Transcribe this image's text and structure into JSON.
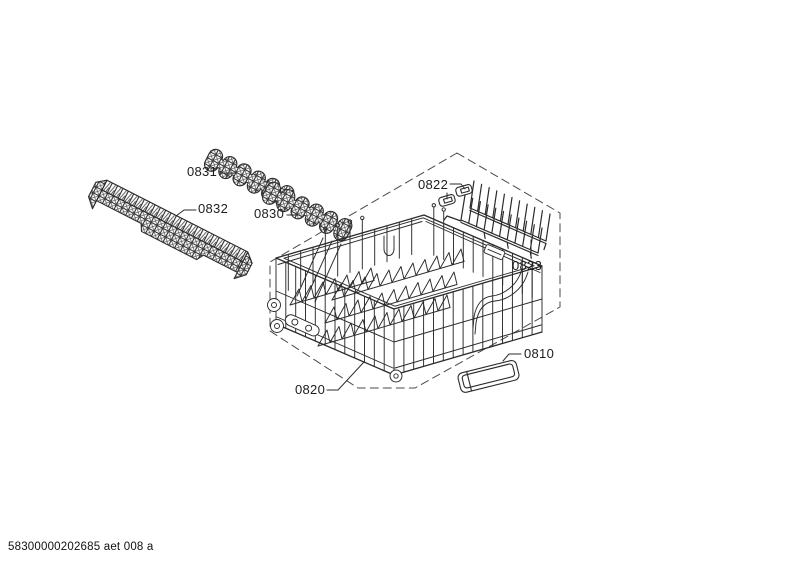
{
  "diagram": {
    "colors": {
      "background": "#ffffff",
      "line": "#2b2b2b",
      "dash": "#4a4a4a"
    },
    "part_labels": {
      "p0831": "0831",
      "p0832": "0832",
      "p0830": "0830",
      "p0822": "0822",
      "p0823": "0823",
      "p0820": "0820",
      "p0810": "0810"
    }
  },
  "footer": {
    "code": "58300000202685 aet 008 a"
  }
}
